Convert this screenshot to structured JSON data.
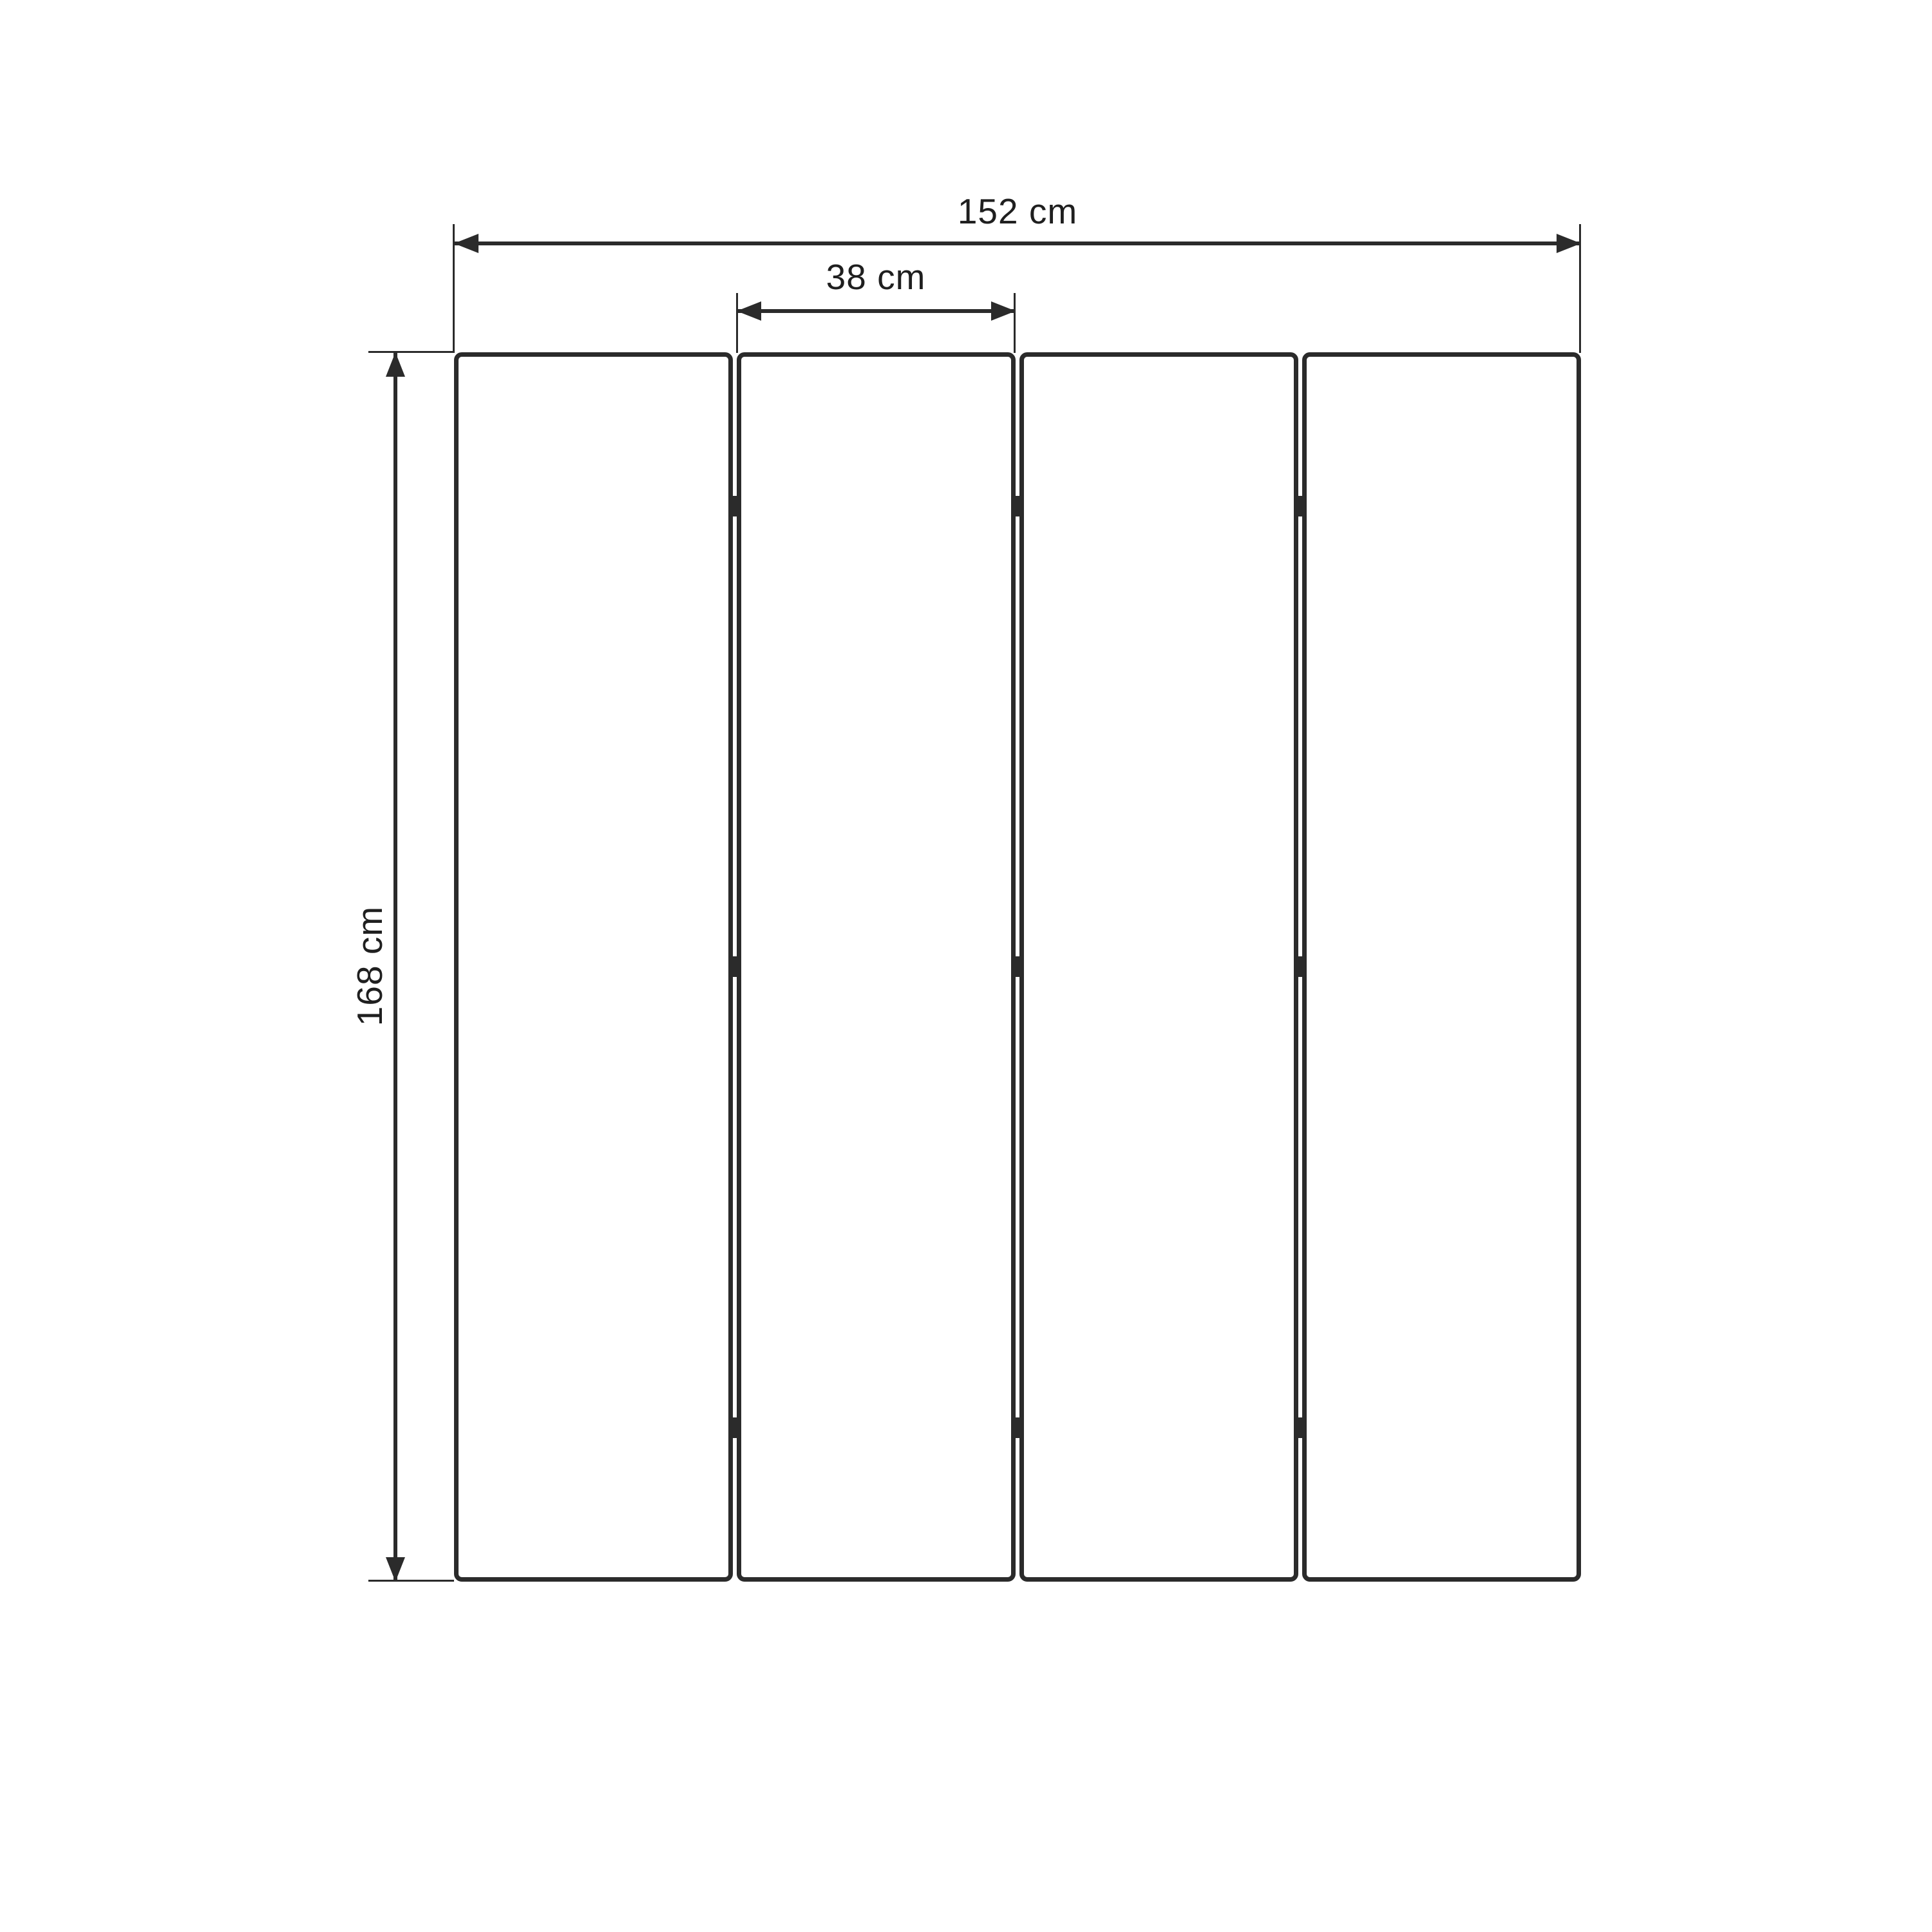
{
  "diagram": {
    "type": "furniture-dimension-drawing",
    "subject": "four-panel folding room divider, front view",
    "panels": {
      "count": 4,
      "hinge_rows": 3,
      "hinge_junctions": 3
    },
    "dimensions": {
      "total_width": {
        "label": "152 cm",
        "value_cm": 152,
        "measures": "overall width of all four panels"
      },
      "panel_width": {
        "label": "38 cm",
        "value_cm": 38,
        "measures": "width of a single panel"
      },
      "height": {
        "label": "168 cm",
        "value_cm": 168,
        "measures": "overall panel height"
      }
    }
  },
  "colors": {
    "line": "#2b2b2b",
    "text": "#1f1f1f",
    "background": "#ffffff"
  }
}
